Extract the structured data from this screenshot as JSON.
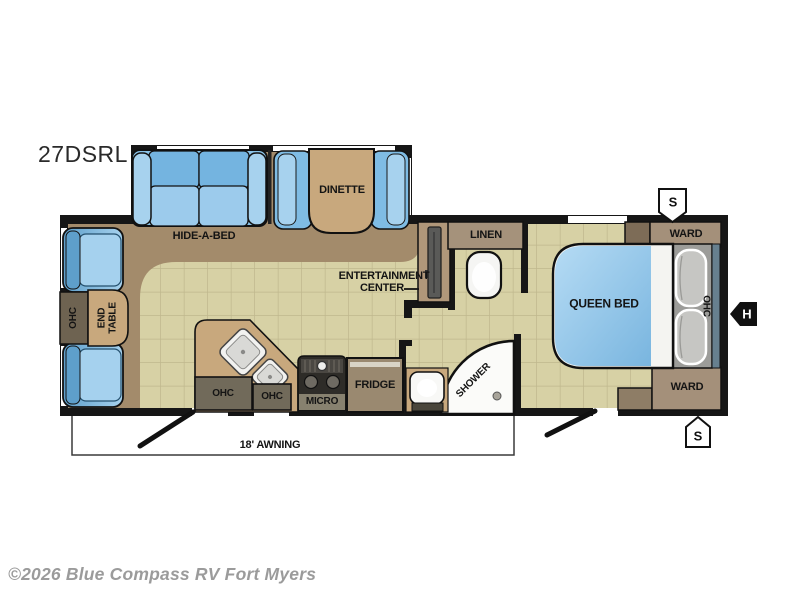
{
  "plan": {
    "model": "27DSRL",
    "watermark": "©2026 Blue Compass RV Fort Myers",
    "awning_label": "18' AWNING",
    "living": {
      "hide_a_bed": "HIDE-A-BED",
      "dinette": "DINETTE",
      "ohc_rear": "OHC",
      "end_table": "END TABLE",
      "entertainment_line1": "ENTERTAINMENT",
      "entertainment_line2": "CENTER"
    },
    "kitchen": {
      "ohc_left": "OHC",
      "ohc_right": "OHC",
      "micro": "MICRO",
      "fridge": "FRIDGE"
    },
    "bath": {
      "linen": "LINEN",
      "shower": "SHOWER"
    },
    "bedroom": {
      "queen_bed": "QUEEN BED",
      "ohc": "OHC",
      "ward_top": "WARD",
      "ward_bottom": "WARD"
    },
    "markers": {
      "speaker_top": "S",
      "speaker_bottom": "S",
      "hookup": "H"
    }
  },
  "colors": {
    "wall": "#161616",
    "tile_floor": "#d7d1a5",
    "tile_grid": "#bfb78d",
    "carpet": "#a38b6b",
    "furniture_blue": "#8ac3e8",
    "furniture_blue_dark": "#5e9fcb",
    "furniture_blue_light": "#a7d2ee",
    "wood_tan": "#c8a87d",
    "cabinet_dark": "#716a5a",
    "cabinet_brown": "#a4907a",
    "fridge_brown": "#9a8970",
    "bed_platform_gray": "#9c9c99",
    "ohc_bed_bluegray": "#67808f",
    "appliance_black": "#2e2c28",
    "white_fixture": "#fbfbf9",
    "watermark_gray": "#9b9b9b"
  }
}
